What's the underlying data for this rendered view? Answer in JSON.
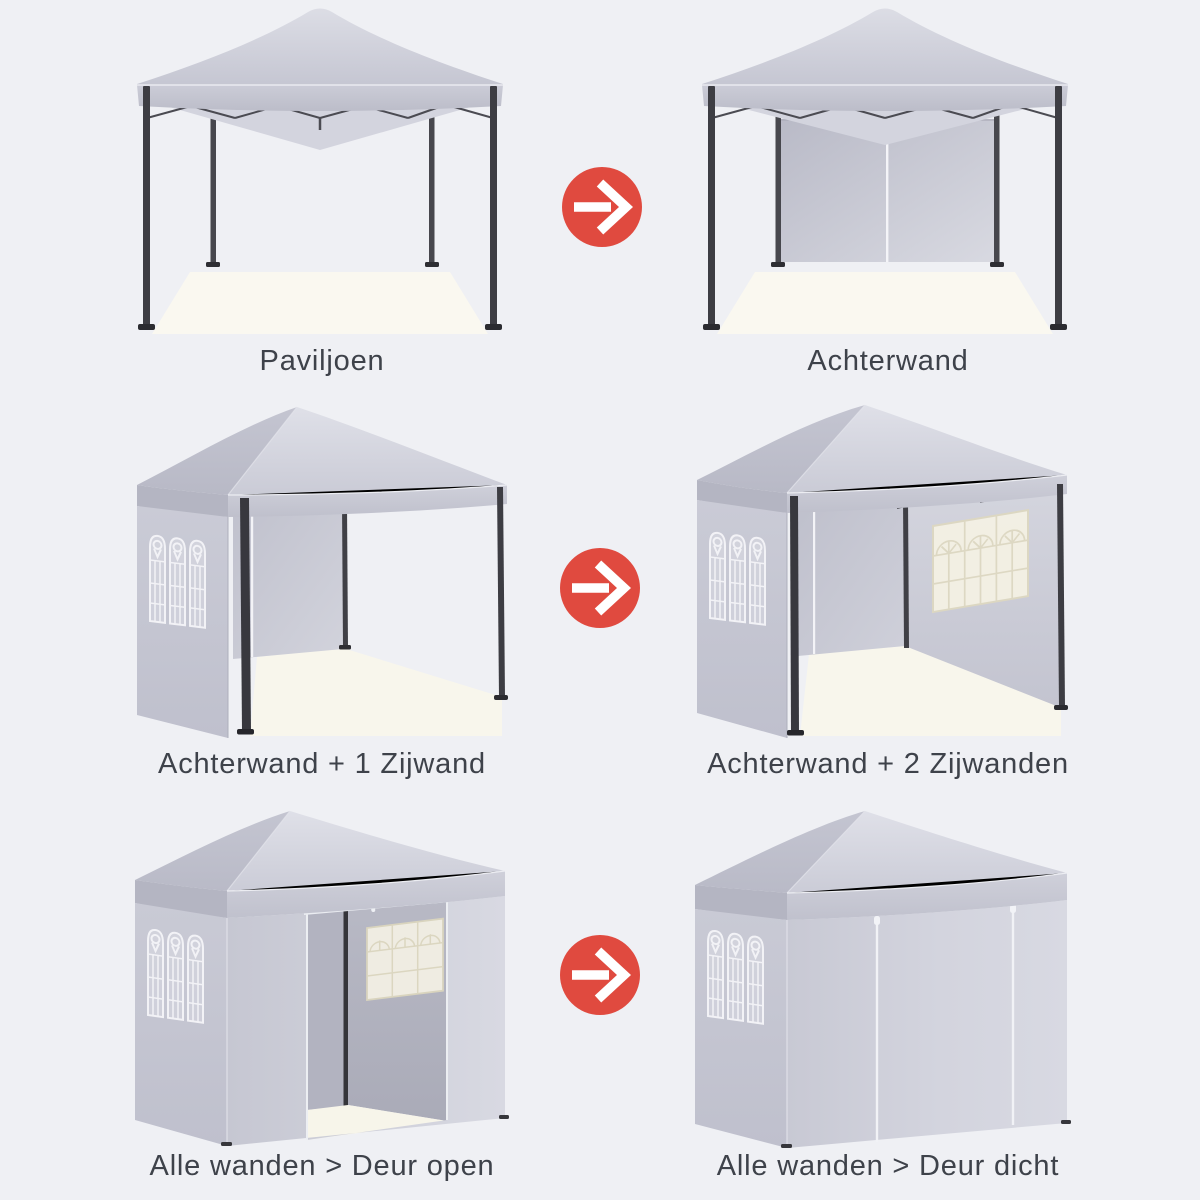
{
  "colors": {
    "background": "#eff0f4",
    "arrow_red": "#e04a3f",
    "caption_text": "#3e424a",
    "canopy_gray": "#c9cad5",
    "frame_dark": "#3a3a3f",
    "floor_warm_white": "#f8f6ec",
    "window_trim_white": "#f2f2f6",
    "window_trim_cream": "#ddd8c3"
  },
  "panels": [
    {
      "id": "paviljoen",
      "label": "Paviljoen",
      "image": "gazebo-frame-only"
    },
    {
      "id": "achterwand",
      "label": "Achterwand",
      "image": "gazebo-back-wall"
    },
    {
      "id": "achterwand-1-zijwand",
      "label": "Achterwand + 1 Zijwand",
      "image": "gazebo-back-wall-one-side-wall"
    },
    {
      "id": "achterwand-2-zijwanden",
      "label": "Achterwand + 2 Zijwanden",
      "image": "gazebo-back-wall-two-side-walls"
    },
    {
      "id": "alle-wanden-deur-open",
      "label": "Alle wanden > Deur open",
      "image": "gazebo-all-walls-door-open"
    },
    {
      "id": "alle-wanden-deur-dicht",
      "label": "Alle wanden > Deur dicht",
      "image": "gazebo-all-walls-door-closed"
    }
  ],
  "arrows": [
    {
      "icon": "arrow-right-icon"
    },
    {
      "icon": "arrow-right-icon"
    },
    {
      "icon": "arrow-right-icon"
    }
  ]
}
